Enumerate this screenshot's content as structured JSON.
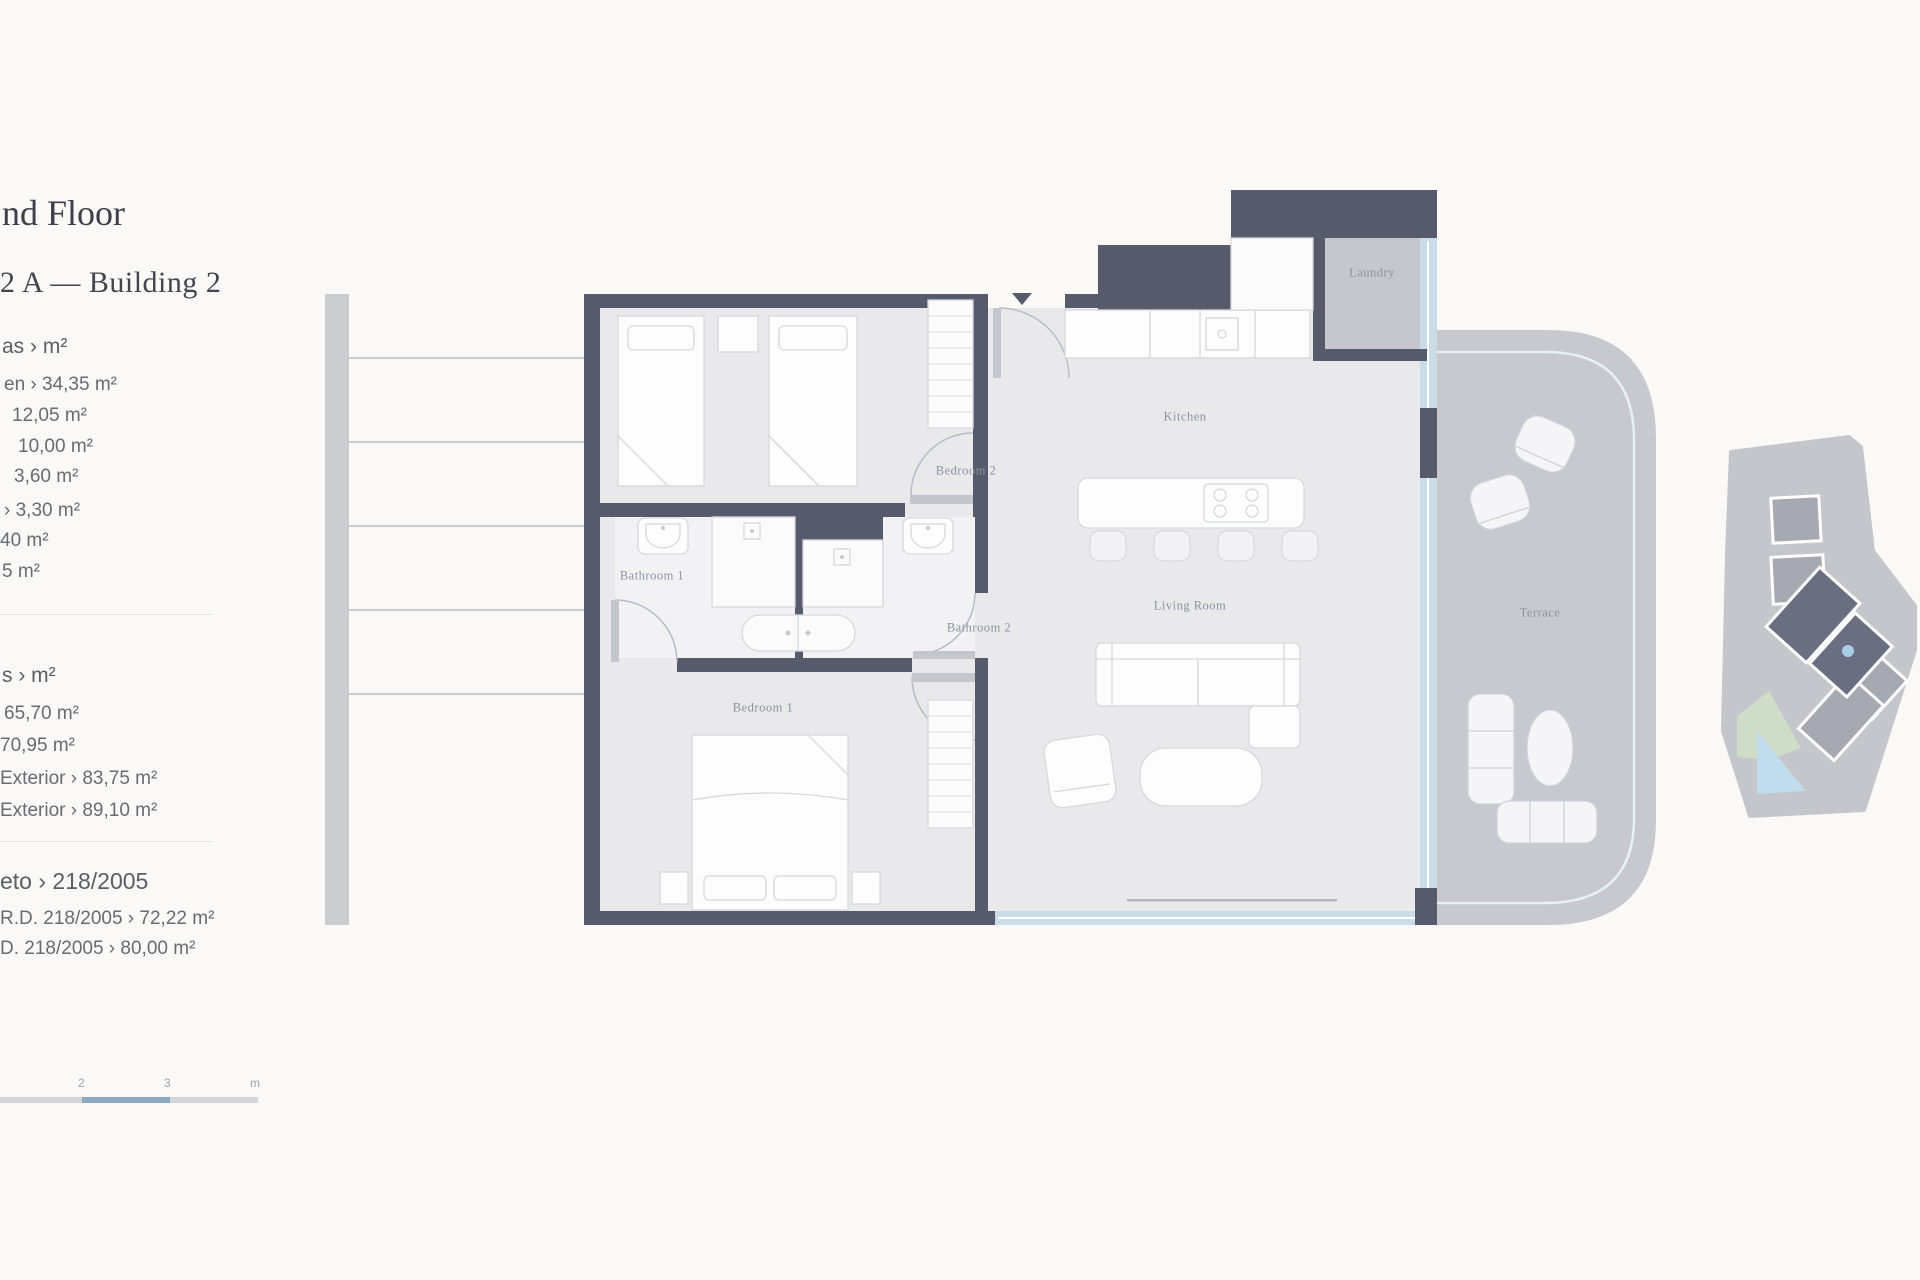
{
  "header": {
    "title_fragment": "nd Floor",
    "subtitle_fragment": "2 A — Building 2"
  },
  "areas_useful": {
    "heading_fragment": "as › m²",
    "items": [
      "en › 34,35 m²",
      "12,05 m²",
      "10,00 m²",
      "3,60 m²",
      "› 3,30 m²",
      "40 m²",
      "5 m²"
    ]
  },
  "areas_built": {
    "heading_fragment": "s › m²",
    "items": [
      "65,70 m²",
      "70,95 m²",
      "Exterior › 83,75 m²",
      "Exterior › 89,10 m²"
    ]
  },
  "decree": {
    "heading_fragment": "eto › 218/2005",
    "items": [
      "R.D. 218/2005 › 72,22 m²",
      "D. 218/2005 › 80,00 m²"
    ]
  },
  "rooms": {
    "kitchen": "Kitchen",
    "living": "Living Room",
    "bedroom1": "Bedroom 1",
    "bedroom2": "Bedroom 2",
    "bathroom1": "Bathroom 1",
    "bathroom2": "Bathroom 2",
    "laundry": "Laundry",
    "terrace": "Terrace"
  },
  "scale_bar": {
    "labels": [
      "2",
      "3",
      "m"
    ]
  },
  "colors": {
    "background": "#faf9f7",
    "wall": "#565a6a",
    "floor": "#e9e9ec",
    "terrace_fill": "#c7c9ce",
    "glass": "#cadce8",
    "scale_segment": "#8ea8bd",
    "locator_dark_block": "#6a6e81",
    "locator_highlight_dot": "#a9cde3"
  }
}
